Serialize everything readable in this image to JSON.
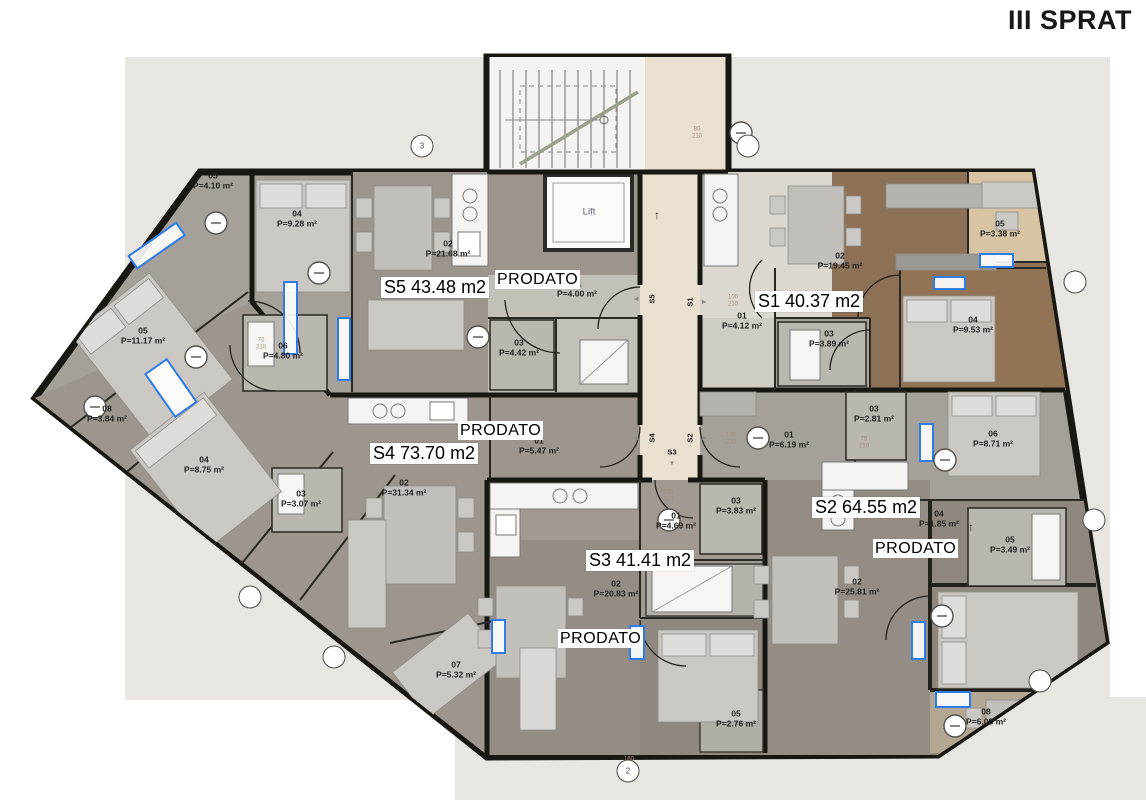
{
  "title": "III SPRAT",
  "floor_plan": {
    "lift": "Lift",
    "apartments": [
      {
        "id": "S5",
        "label": "S5 43.48 m2",
        "x": 381,
        "y": 277,
        "sold": "PRODATO",
        "sold_x": 495,
        "sold_y": 270
      },
      {
        "id": "S1",
        "label": "S1 40.37 m2",
        "x": 755,
        "y": 291,
        "sold": null,
        "sold_x": 0,
        "sold_y": 0
      },
      {
        "id": "S4",
        "label": "S4 73.70 m2",
        "x": 370,
        "y": 443,
        "sold": "PRODATO",
        "sold_x": 458,
        "sold_y": 421
      },
      {
        "id": "S2",
        "label": "S2 64.55 m2",
        "x": 812,
        "y": 497,
        "sold": "PRODATO",
        "sold_x": 873,
        "sold_y": 539
      },
      {
        "id": "S3",
        "label": "S3 41.41 m2",
        "x": 586,
        "y": 550,
        "sold": "PRODATO",
        "sold_x": 558,
        "sold_y": 629
      }
    ],
    "rooms": [
      {
        "apt": "S5",
        "num": "05",
        "area": "P=4.10 m²",
        "x": 213,
        "y": 182
      },
      {
        "apt": "S5",
        "num": "04",
        "area": "P=9.28 m²",
        "x": 297,
        "y": 220
      },
      {
        "apt": "S5",
        "num": "02",
        "area": "P=21.68 m²",
        "x": 448,
        "y": 250
      },
      {
        "apt": "S5",
        "num": "01",
        "area": "P=4.00 m²",
        "x": 577,
        "y": 290
      },
      {
        "apt": "S5",
        "num": "03",
        "area": "P=4.42 m²",
        "x": 519,
        "y": 349
      },
      {
        "apt": "S1",
        "num": "02",
        "area": "P=19.45 m²",
        "x": 840,
        "y": 262
      },
      {
        "apt": "S1",
        "num": "01",
        "area": "P=4.12 m²",
        "x": 742,
        "y": 322
      },
      {
        "apt": "S1",
        "num": "03",
        "area": "P=3.89 m²",
        "x": 829,
        "y": 340
      },
      {
        "apt": "S1",
        "num": "04",
        "area": "P=9.53 m²",
        "x": 973,
        "y": 326
      },
      {
        "apt": "S1",
        "num": "05",
        "area": "P=3.38 m²",
        "x": 1000,
        "y": 230
      },
      {
        "apt": "S4",
        "num": "05",
        "area": "P=11.17 m²",
        "x": 143,
        "y": 337
      },
      {
        "apt": "S4",
        "num": "06",
        "area": "P=4.80 m²",
        "x": 283,
        "y": 352
      },
      {
        "apt": "S4",
        "num": "08",
        "area": "P=3.84 m²",
        "x": 107,
        "y": 415
      },
      {
        "apt": "S4",
        "num": "04",
        "area": "P=8.75 m²",
        "x": 204,
        "y": 466
      },
      {
        "apt": "S4",
        "num": "03",
        "area": "P=3.07 m²",
        "x": 301,
        "y": 500
      },
      {
        "apt": "S4",
        "num": "02",
        "area": "P=31.34 m²",
        "x": 404,
        "y": 489
      },
      {
        "apt": "S4",
        "num": "01",
        "area": "P=5.47 m²",
        "x": 539,
        "y": 447
      },
      {
        "apt": "S4",
        "num": "07",
        "area": "P=5.32 m²",
        "x": 456,
        "y": 671
      },
      {
        "apt": "S2",
        "num": "01",
        "area": "P=6.19 m²",
        "x": 789,
        "y": 441
      },
      {
        "apt": "S2",
        "num": "03",
        "area": "P=2.81 m²",
        "x": 874,
        "y": 415
      },
      {
        "apt": "S2",
        "num": "06",
        "area": "P=8.71 m²",
        "x": 993,
        "y": 440
      },
      {
        "apt": "S2",
        "num": "04",
        "area": "P=1.85 m²",
        "x": 939,
        "y": 520
      },
      {
        "apt": "S2",
        "num": "05",
        "area": "P=3.49 m²",
        "x": 1010,
        "y": 546
      },
      {
        "apt": "S2",
        "num": "02",
        "area": "P=25.81 m²",
        "x": 857,
        "y": 588
      },
      {
        "apt": "S2",
        "num": "08",
        "area": "P=6.08 m²",
        "x": 986,
        "y": 718
      },
      {
        "apt": "S3",
        "num": "01",
        "area": "P=4.69 m²",
        "x": 676,
        "y": 522
      },
      {
        "apt": "S3",
        "num": "03",
        "area": "P=3.83 m²",
        "x": 736,
        "y": 507
      },
      {
        "apt": "S3",
        "num": "02",
        "area": "P=20.83 m²",
        "x": 616,
        "y": 590
      },
      {
        "apt": "S3",
        "num": "05",
        "area": "P=2.76 m²",
        "x": 736,
        "y": 720
      }
    ],
    "entrance_tags": [
      {
        "id": "S5",
        "x": 652,
        "y": 299,
        "rot": -90
      },
      {
        "id": "S1",
        "x": 690,
        "y": 302,
        "rot": -90
      },
      {
        "id": "S4",
        "x": 652,
        "y": 438,
        "rot": -90
      },
      {
        "id": "S2",
        "x": 690,
        "y": 438,
        "rot": -90
      },
      {
        "id": "S3",
        "x": 672,
        "y": 452,
        "rot": 0
      }
    ],
    "entrance_arrows": [
      {
        "glyph": "◀",
        "x": 636,
        "y": 299
      },
      {
        "glyph": "▶",
        "x": 704,
        "y": 302
      },
      {
        "glyph": "◀",
        "x": 636,
        "y": 438
      },
      {
        "glyph": "▶",
        "x": 704,
        "y": 438
      },
      {
        "glyph": "▼",
        "x": 672,
        "y": 464
      }
    ],
    "direction_arrows": [
      {
        "glyph": "↑",
        "x": 657,
        "y": 215
      },
      {
        "glyph": "↑",
        "x": 971,
        "y": 527
      }
    ],
    "grid_bubbles": [
      {
        "label": "3",
        "x": 422,
        "y": 146
      },
      {
        "label": "",
        "x": 748,
        "y": 146
      },
      {
        "label": "",
        "x": 250,
        "y": 597
      },
      {
        "label": "",
        "x": 334,
        "y": 657
      },
      {
        "label": "2",
        "x": 628,
        "y": 771
      },
      {
        "label": "",
        "x": 1040,
        "y": 681
      },
      {
        "label": "",
        "x": 1075,
        "y": 282
      },
      {
        "label": "",
        "x": 1094,
        "y": 520
      }
    ],
    "dim_labels": [
      {
        "lines": "100 210",
        "x": 733,
        "y": 301
      },
      {
        "lines": "100 210",
        "x": 731,
        "y": 439
      },
      {
        "lines": "70 210",
        "x": 261,
        "y": 344
      },
      {
        "lines": "75 210",
        "x": 864,
        "y": 443
      },
      {
        "lines": "100 210",
        "x": 668,
        "y": 496
      },
      {
        "lines": "80 210",
        "x": 697,
        "y": 133
      },
      {
        "lines": "160 190",
        "x": 629,
        "y": 763
      }
    ]
  }
}
